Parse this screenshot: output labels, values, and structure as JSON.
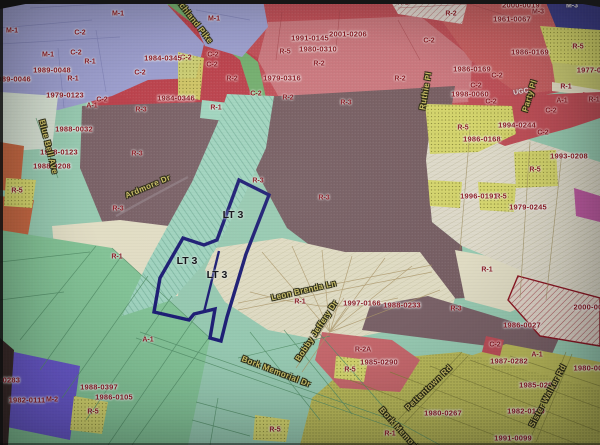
{
  "map": {
    "description": "Photographed zoning parcel map with highlighted lot",
    "highlighted_lot": "LT 3",
    "palette": {
      "highlight_outline": "#1b1b78",
      "parcel_text": "#8e1822",
      "street_text": "#d3c76a",
      "zone_R1_mint": "#9cd2b8",
      "zone_R1_cream": "#ebe7cd",
      "zone_R3_brown": "#7c6369",
      "zone_C2_red": "#c24a55",
      "zone_R2_pink": "#d07a82",
      "zone_M1_lavender": "#a0a3d6",
      "zone_M2_purple": "#6a5ad2",
      "zone_M3_navy": "#3d3f90",
      "zone_R5_yellow": "#dcdd70",
      "zone_A1_olive": "#c2c25c",
      "zone_A1_green": "#87cb9c",
      "orange": "#cc6a43",
      "magenta": "#c45da8"
    },
    "labels": {
      "lots": [
        {
          "t": "LT 3",
          "x": 233,
          "y": 215
        },
        {
          "t": "LT 3",
          "x": 187,
          "y": 261
        },
        {
          "t": "LT 3",
          "x": 217,
          "y": 275
        }
      ],
      "streets": [
        {
          "t": "Richland Pike",
          "x": 193,
          "y": 20,
          "r": 52
        },
        {
          "t": "Blue Bell Ave",
          "x": 48,
          "y": 147,
          "r": 76
        },
        {
          "t": "Ardmore Dr",
          "x": 148,
          "y": 187,
          "r": -23
        },
        {
          "t": "Leon Brenda Ln",
          "x": 304,
          "y": 291,
          "r": -13
        },
        {
          "t": "Bobby Jeffery Dr",
          "x": 317,
          "y": 331,
          "r": -57
        },
        {
          "t": "Bork Memorial Dr",
          "x": 276,
          "y": 372,
          "r": 21
        },
        {
          "t": "Bork Memorial Dr",
          "x": 405,
          "y": 436,
          "r": 48
        },
        {
          "t": "Pettentown Rd",
          "x": 429,
          "y": 388,
          "r": -44
        },
        {
          "t": "Sister Walker Rd",
          "x": 548,
          "y": 396,
          "r": -62
        },
        {
          "t": "Party Pl",
          "x": 530,
          "y": 96,
          "r": -73
        },
        {
          "t": "Ruthie Pl",
          "x": 426,
          "y": 91,
          "r": -80
        }
      ],
      "zones": [
        {
          "t": "M-1",
          "x": 12,
          "y": 31
        },
        {
          "t": "M-1",
          "x": 48,
          "y": 55
        },
        {
          "t": "M-1",
          "x": 118,
          "y": 14
        },
        {
          "t": "M-1",
          "x": 214,
          "y": 19
        },
        {
          "t": "C-2",
          "x": 80,
          "y": 33
        },
        {
          "t": "C-2",
          "x": 76,
          "y": 53
        },
        {
          "t": "C-2",
          "x": 102,
          "y": 100
        },
        {
          "t": "C-2",
          "x": 140,
          "y": 73
        },
        {
          "t": "C-2",
          "x": 186,
          "y": 58
        },
        {
          "t": "C-2",
          "x": 256,
          "y": 94
        },
        {
          "t": "C-2",
          "x": 213,
          "y": 55
        },
        {
          "t": "C-2",
          "x": 212,
          "y": 65
        },
        {
          "t": "C-2",
          "x": 429,
          "y": 41
        },
        {
          "t": "C-2",
          "x": 497,
          "y": 76
        },
        {
          "t": "C-2",
          "x": 476,
          "y": 86
        },
        {
          "t": "C-2",
          "x": 491,
          "y": 102
        },
        {
          "t": "C-2",
          "x": 551,
          "y": 111
        },
        {
          "t": "C-2",
          "x": 543,
          "y": 133
        },
        {
          "t": "C-2",
          "x": 495,
          "y": 345
        },
        {
          "t": "R-1",
          "x": 90,
          "y": 62
        },
        {
          "t": "R-1",
          "x": 73,
          "y": 79
        },
        {
          "t": "R-1",
          "x": 216,
          "y": 108
        },
        {
          "t": "R-1",
          "x": 403,
          "y": 3
        },
        {
          "t": "R-1",
          "x": 566,
          "y": 87
        },
        {
          "t": "R-1",
          "x": 594,
          "y": 100
        },
        {
          "t": "R-1",
          "x": 117,
          "y": 257
        },
        {
          "t": "R-1",
          "x": 300,
          "y": 302
        },
        {
          "t": "R-1",
          "x": 487,
          "y": 270
        },
        {
          "t": "R-1",
          "x": 390,
          "y": 434
        },
        {
          "t": "R-2",
          "x": 232,
          "y": 79
        },
        {
          "t": "R-2",
          "x": 319,
          "y": 64
        },
        {
          "t": "R-2",
          "x": 288,
          "y": 98
        },
        {
          "t": "R-2",
          "x": 451,
          "y": 14
        },
        {
          "t": "R-2",
          "x": 400,
          "y": 79
        },
        {
          "t": "R-3",
          "x": 346,
          "y": 103
        },
        {
          "t": "R-3",
          "x": 141,
          "y": 110
        },
        {
          "t": "R-3",
          "x": 137,
          "y": 154
        },
        {
          "t": "R-3",
          "x": 118,
          "y": 209
        },
        {
          "t": "R-3",
          "x": 258,
          "y": 181
        },
        {
          "t": "R-3",
          "x": 324,
          "y": 198
        },
        {
          "t": "R-3",
          "x": 456,
          "y": 309
        },
        {
          "t": "R-5",
          "x": 285,
          "y": 52
        },
        {
          "t": "R-5",
          "x": 578,
          "y": 47
        },
        {
          "t": "R-5",
          "x": 17,
          "y": 191
        },
        {
          "t": "R-5",
          "x": 463,
          "y": 128
        },
        {
          "t": "R-5",
          "x": 535,
          "y": 170
        },
        {
          "t": "R-5",
          "x": 501,
          "y": 197
        },
        {
          "t": "R-5",
          "x": 350,
          "y": 370
        },
        {
          "t": "R-5",
          "x": 275,
          "y": 430
        },
        {
          "t": "R-5",
          "x": 93,
          "y": 412
        },
        {
          "t": "A-1",
          "x": 92,
          "y": 106
        },
        {
          "t": "A-1",
          "x": 562,
          "y": 101
        },
        {
          "t": "A-1",
          "x": 148,
          "y": 340
        },
        {
          "t": "A-1",
          "x": 537,
          "y": 355
        },
        {
          "t": "M-3",
          "x": 538,
          "y": 12
        },
        {
          "t": "M-2",
          "x": 52,
          "y": 400
        },
        {
          "t": "R-2A",
          "x": 363,
          "y": 350
        }
      ],
      "parcels": [
        {
          "t": "1989-0046",
          "x": 12,
          "y": 79
        },
        {
          "t": "1989-0048",
          "x": 52,
          "y": 70
        },
        {
          "t": "1979-0123",
          "x": 65,
          "y": 95
        },
        {
          "t": "1984-0345",
          "x": 163,
          "y": 58
        },
        {
          "t": "1984-0346",
          "x": 176,
          "y": 98
        },
        {
          "t": "1991-0145",
          "x": 310,
          "y": 38
        },
        {
          "t": "2001-0206",
          "x": 348,
          "y": 34
        },
        {
          "t": "1980-0310",
          "x": 318,
          "y": 49
        },
        {
          "t": "1979-0316",
          "x": 282,
          "y": 78
        },
        {
          "t": "2000-0019",
          "x": 521,
          "y": 5
        },
        {
          "t": "1961-0067",
          "x": 512,
          "y": 19
        },
        {
          "t": "1986-0169",
          "x": 530,
          "y": 52
        },
        {
          "t": "1986-0169",
          "x": 472,
          "y": 69
        },
        {
          "t": "1998-0060",
          "x": 470,
          "y": 94
        },
        {
          "t": "1977-0",
          "x": 589,
          "y": 70
        },
        {
          "t": "1988-0032",
          "x": 74,
          "y": 129
        },
        {
          "t": "1988-0123",
          "x": 59,
          "y": 152
        },
        {
          "t": "1988-0208",
          "x": 52,
          "y": 166
        },
        {
          "t": "1994-0244",
          "x": 517,
          "y": 125
        },
        {
          "t": "1986-0168",
          "x": 482,
          "y": 139
        },
        {
          "t": "1993-0208",
          "x": 569,
          "y": 156
        },
        {
          "t": "1996-0191",
          "x": 479,
          "y": 196
        },
        {
          "t": "1979-0245",
          "x": 528,
          "y": 207
        },
        {
          "t": "1997-0166",
          "x": 362,
          "y": 303
        },
        {
          "t": "1988-0233",
          "x": 402,
          "y": 305
        },
        {
          "t": "1985-0290",
          "x": 379,
          "y": 362
        },
        {
          "t": "1986-0027",
          "x": 522,
          "y": 325
        },
        {
          "t": "2000-00",
          "x": 588,
          "y": 307
        },
        {
          "t": "1987-0282",
          "x": 509,
          "y": 361
        },
        {
          "t": "1980-00",
          "x": 588,
          "y": 368
        },
        {
          "t": "1985-0292",
          "x": 538,
          "y": 385
        },
        {
          "t": "1982-0160",
          "x": 526,
          "y": 411
        },
        {
          "t": "1980-0267",
          "x": 443,
          "y": 413
        },
        {
          "t": "1991-0099",
          "x": 513,
          "y": 438
        },
        {
          "t": "1982-0111",
          "x": 27,
          "y": 400
        },
        {
          "t": "1988-0397",
          "x": 99,
          "y": 387
        },
        {
          "t": "1986-0105",
          "x": 114,
          "y": 397
        },
        {
          "t": "-0283",
          "x": 10,
          "y": 380
        }
      ],
      "white": [
        {
          "t": "M-3",
          "x": 572,
          "y": 6
        },
        {
          "t": "UGC",
          "x": 521,
          "y": 92,
          "r": -10
        }
      ]
    }
  }
}
